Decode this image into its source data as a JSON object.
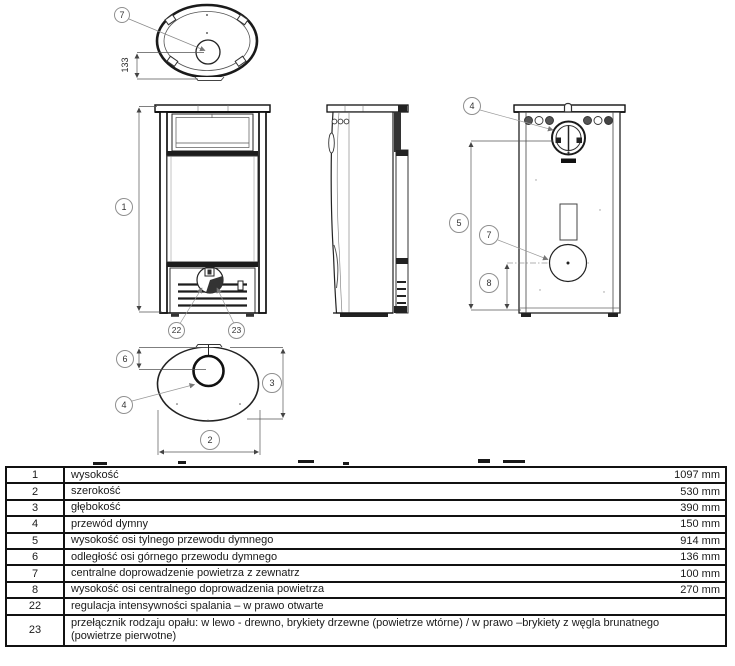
{
  "diagram": {
    "callouts": {
      "top_view_flue": "7",
      "front_height": "1",
      "front_air_control": "22",
      "front_fuel_switch": "23",
      "back_flue": "4",
      "back_flue_height": "5",
      "back_air_inlet": "7",
      "back_air_inlet_height": "8",
      "bottom_flue_offset": "6",
      "bottom_flue": "4",
      "bottom_depth": "3",
      "bottom_width": "2"
    },
    "dimensions": {
      "top_view_flue_offset": "133"
    }
  },
  "table": {
    "rows": [
      {
        "no": "1",
        "desc": "wysokość",
        "value": "1097 mm"
      },
      {
        "no": "2",
        "desc": "szerokość",
        "value": "530 mm"
      },
      {
        "no": "3",
        "desc": "głębokość",
        "value": "390 mm"
      },
      {
        "no": "4",
        "desc": "przewód dymny",
        "value": "150 mm"
      },
      {
        "no": "5",
        "desc": "wysokość osi tylnego przewodu dymnego",
        "value": "914 mm"
      },
      {
        "no": "6",
        "desc": "odległość osi górnego przewodu dymnego",
        "value": "136 mm"
      },
      {
        "no": "7",
        "desc": "centralne doprowadzenie powietrza z zewnatrz",
        "value": "100 mm"
      },
      {
        "no": "8",
        "desc": "wysokość osi centralnego doprowadzenia powietrza",
        "value": "270 mm"
      },
      {
        "no": "22",
        "desc": "regulacja intensywności spalania – w prawo otwarte",
        "value": ""
      },
      {
        "no": "23",
        "desc": "przełącznik rodzaju opału: w lewo - drewno, brykiety drzewne (powietrze wtórne) / w prawo –brykiety z węgla brunatnego (powietrze pierwotne)",
        "value": ""
      }
    ]
  }
}
